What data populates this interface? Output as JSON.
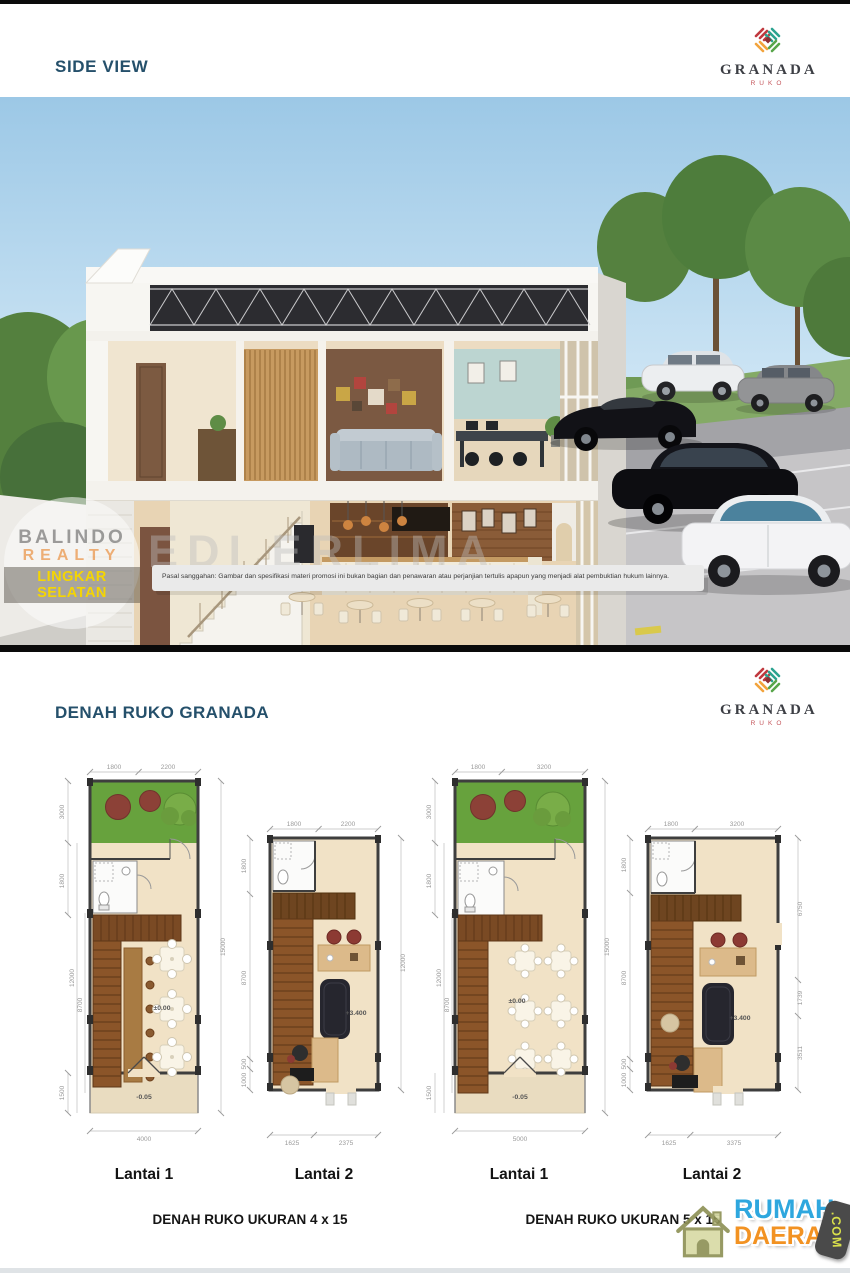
{
  "header": {
    "title": "SIDE VIEW"
  },
  "brand": {
    "name": "GRANADA",
    "subtitle": "RUKO"
  },
  "rendering": {
    "disclaimer": "Pasal sanggahan: Gambar dan spesifikasi materi promosi ini bukan bagian dan penawaran atau perjanjian tertulis apapun yang menjadi alat pembuktian hukum lainnya."
  },
  "watermarks": {
    "stamp_line1": "BALINDO",
    "stamp_line2": "REALTY",
    "stamp_line3": "LINGKAR SELATAN",
    "diagonal": "EDI ERLIMA"
  },
  "plans_section": {
    "title_prefix": "DENAH",
    "title_bold": "RUKO GRANADA",
    "caption_left": "DENAH RUKO UKURAN 4 x 15",
    "caption_right": "DENAH RUKO UKURAN 5 x 15"
  },
  "plans": [
    {
      "label": "Lantai 1",
      "dims": {
        "top": [
          "1800",
          "2200"
        ],
        "left": [
          "3000",
          "1800",
          "12000",
          "8700",
          "1500"
        ],
        "right": [
          "15000"
        ],
        "bottom": [
          "4000"
        ]
      },
      "levels": [
        "±0.00",
        "-0.05"
      ]
    },
    {
      "label": "Lantai 2",
      "dims": {
        "top": [
          "1800",
          "2200"
        ],
        "left": [
          "1800",
          "8700",
          "500",
          "1000"
        ],
        "right": [
          "12000"
        ],
        "bottom": [
          "1625",
          "2375"
        ]
      },
      "levels": [
        "+3.400"
      ]
    },
    {
      "label": "Lantai 1",
      "dims": {
        "top": [
          "1800",
          "3200"
        ],
        "left": [
          "3000",
          "1800",
          "12000",
          "8700",
          "1500"
        ],
        "right": [
          "15000"
        ],
        "bottom": [
          "5000"
        ]
      },
      "levels": [
        "±0.00",
        "-0.05"
      ]
    },
    {
      "label": "Lantai 2",
      "dims": {
        "top": [
          "1800",
          "3200"
        ],
        "left": [
          "1800",
          "8700",
          "500",
          "1000"
        ],
        "right": [
          "6750",
          "1739",
          "3511"
        ],
        "bottom": [
          "1625",
          "3375"
        ]
      },
      "levels": [
        "+3.400"
      ]
    }
  ],
  "footer_logo": {
    "word1": "RUMAH",
    "word2": "DAERAH",
    "badge": ".COM"
  }
}
